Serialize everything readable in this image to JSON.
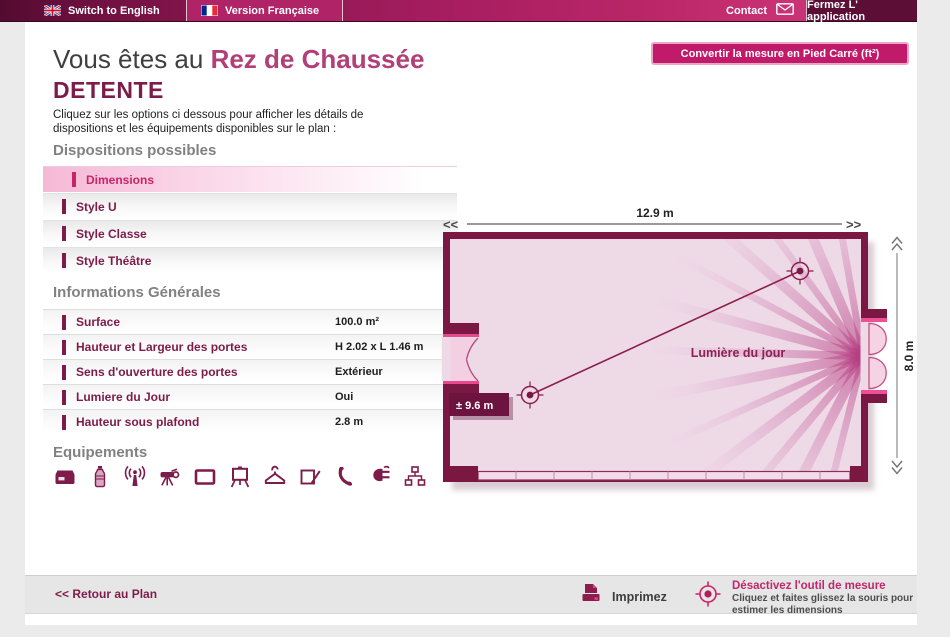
{
  "topbar": {
    "switch_english": "Switch to English",
    "version_francaise": "Version Française",
    "contact": "Contact",
    "fermez": "Fermez L' application"
  },
  "header": {
    "prefix": "Vous êtes au ",
    "location": "Rez de Chaussée",
    "room": "DETENTE",
    "intro_line1": "Cliquez sur les options ci dessous pour afficher les détails de",
    "intro_line2": "dispositions et les équipements disponibles sur le plan :",
    "convert_button": "Convertir la mesure en Pied Carré (ft²)"
  },
  "dispositions": {
    "title": "Dispositions possibles",
    "items": [
      {
        "label": "Dimensions",
        "active": true
      },
      {
        "label": "Style U",
        "active": false
      },
      {
        "label": "Style Classe",
        "active": false
      },
      {
        "label": "Style Théâtre",
        "active": false
      }
    ]
  },
  "informations": {
    "title": "Informations Générales",
    "rows": [
      {
        "label": "Surface",
        "value": "100.0 m²"
      },
      {
        "label": "Hauteur et Largeur des portes",
        "value": "H 2.02 x L 1.46 m"
      },
      {
        "label": "Sens d'ouverture des portes",
        "value": "Extérieur"
      },
      {
        "label": "Lumiere du Jour",
        "value": "Oui"
      },
      {
        "label": "Hauteur sous plafond",
        "value": "2.8 m"
      }
    ]
  },
  "equipements": {
    "title": "Equipements",
    "icons": [
      "storage-box",
      "water-bottle",
      "wireless-signal",
      "video-projector",
      "screen",
      "flipchart",
      "coat-hanger",
      "notepad-pen",
      "telephone",
      "power-plug",
      "network"
    ]
  },
  "plan": {
    "width_label": "12.9 m",
    "height_label": "8.0 m",
    "measure_label": "± 9.6 m",
    "daylight_label": "Lumière du jour",
    "scroll_left": "<<",
    "scroll_right": ">>"
  },
  "footer": {
    "back": "<< Retour au Plan",
    "print": "Imprimez",
    "measure_title": "Désactivez l'outil de mesure",
    "measure_line1": "Cliquez et faites glissez la souris pour",
    "measure_line2": "estimer les dimensions"
  },
  "colors": {
    "wall_maroon": "#7a1743",
    "room_fill": "#eed9e7",
    "accent_pink": "#e8488d",
    "brand_pink": "#c21a6b",
    "label_maroon": "#7d1b4a"
  }
}
